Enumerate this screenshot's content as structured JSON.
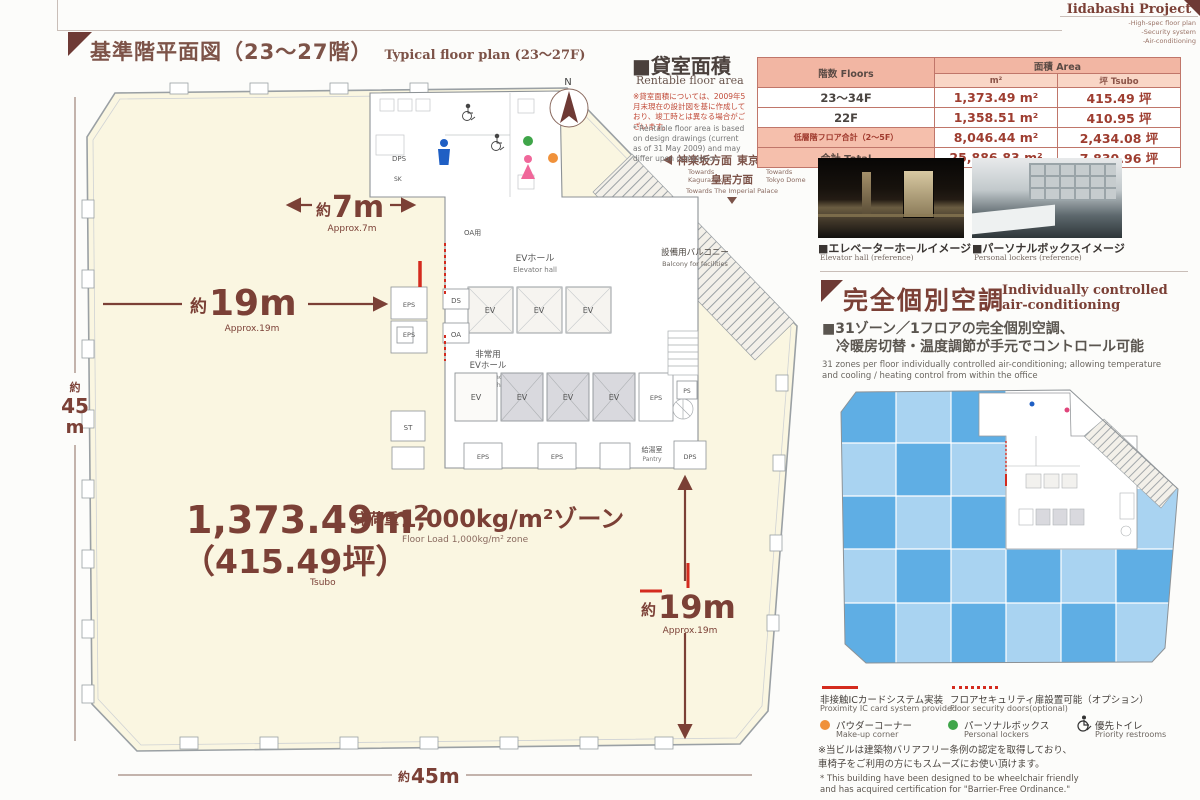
{
  "header": {
    "brand": "Iidabashi Project",
    "sub": [
      "-High-spec floor plan",
      "-Security system",
      "-Air-conditioning"
    ]
  },
  "title": {
    "jp": "基準階平面図（23〜27階）",
    "en": "Typical floor plan (23〜27F)"
  },
  "rentable": {
    "heading_jp": "■貸室面積",
    "heading_en": "Rentable floor area",
    "note_jp": "※貸室面積については、2009年5月末現在の設計図を基に作成しており、竣工時とは異なる場合がございます。",
    "note_en": "* Rentable floor area is based on design drawings (current as of 31 May 2009) and may differ upon completion.",
    "table": {
      "col_floors": "階数 Floors",
      "col_area": "面積 Area",
      "col_m2": "m²",
      "col_tsubo": "坪 Tsubo",
      "rows": [
        {
          "floor": "23〜34F",
          "m2": "1,373.49 m²",
          "tsubo": "415.49 坪"
        },
        {
          "floor": "22F",
          "m2": "1,358.51 m²",
          "tsubo": "410.95 坪"
        },
        {
          "floor": "低層階フロア合計（2〜5F）",
          "m2": "8,046.44 m²",
          "tsubo": "2,434.08 坪"
        },
        {
          "floor": "合計 Total",
          "m2": "25,886.83 m²",
          "tsubo": "7,830.96 坪"
        }
      ]
    }
  },
  "photos": {
    "elevator_jp": "■エレベーターホールイメージ",
    "elevator_en": "Elevator hall (reference)",
    "lockers_jp": "■パーソナルボックスイメージ",
    "lockers_en": "Personal lockers (reference)"
  },
  "aircon": {
    "title_jp": "完全個別空調",
    "title_en1": "Individually controlled",
    "title_en2": "air-conditioning",
    "sub_jp1": "■31ゾーン／1フロアの完全個別空調、",
    "sub_jp2": "冷暖房切替・温度調節が手元でコントロール可能",
    "body_en1": "31 zones per floor individually controlled air-conditioning; allowing temperature",
    "body_en2": "and cooling / heating control from within the office"
  },
  "legend": {
    "ic_jp": "非接触ICカードシステム実装",
    "ic_en": "Proximity IC card system provided",
    "door_jp": "フロアセキュリティ扉設置可能（オプション）",
    "door_en": "Floor security doors(optional)",
    "makeup_jp": "パウダーコーナー",
    "makeup_en": "Make-up corner",
    "locker_jp": "パーソナルボックス",
    "locker_en": "Personal lockers",
    "priority_jp": "優先トイレ",
    "priority_en": "Priority restrooms",
    "note_jp1": "※当ビルは建築物バリアフリー条例の認定を取得しており、",
    "note_jp2": "車椅子をご利用の方にもスムーズにお使い頂けます。",
    "note_en1": "* This building have been designed to be wheelchair friendly",
    "note_en2": "and has acquired certification for \"Barrier-Free Ordinance.\""
  },
  "plan": {
    "compass_n": "N",
    "dim7": {
      "prefix": "約",
      "value": "7m",
      "en": "Approx.7m"
    },
    "dim19": {
      "prefix": "約",
      "value": "19m",
      "en": "Approx.19m"
    },
    "dim45v": {
      "prefix": "約",
      "num": "45",
      "unit": "m"
    },
    "dim45b": {
      "prefix": "約",
      "value": "45m"
    },
    "area": {
      "m2": "1,373.49m²",
      "tsubo": "（415.49坪）",
      "tsubo_en": "Tsubo"
    },
    "load": {
      "jp_prefix": "床荷重",
      "jp_value": "1,000kg/m²ゾーン",
      "en": "Floor Load 1,000kg/m² zone"
    },
    "directions": {
      "kagurazaka_jp": "神楽坂方面",
      "kagurazaka_en1": "Towards",
      "kagurazaka_en2": "Kagurazaka",
      "dome_jp": "東京ドーム方面",
      "dome_en1": "Towards",
      "dome_en2": "Tokyo Dome",
      "palace_jp": "皇居方面",
      "palace_en": "Towards The Imperial Palace"
    },
    "balcony_jp": "設備用バルコニー",
    "balcony_en": "Balcony for facilities",
    "labels": {
      "ev_hall_jp": "EVホール",
      "ev_hall_en": "Elevator hall",
      "emg1": "非常用",
      "emg2": "EVホール",
      "emg_en1": "Emergency",
      "emg_en2": "Elevator hall",
      "pantry_jp": "給湯室",
      "pantry_en": "Pantry",
      "ev": "EV",
      "eps": "EPS",
      "ps": "PS",
      "ds": "DS",
      "oa": "OA",
      "oa_room": "OA用",
      "st": "ST",
      "dps": "DPS",
      "sk": "SK"
    }
  },
  "colors": {
    "accent_maroon": "#6E3A35",
    "dim_red": "#7B4036",
    "security_red": "#D42B1E",
    "table_header_bg": "#F2B6A3",
    "table_value_text": "#9E3D30",
    "office_cream": "#FAF6E1",
    "zone_blue_light": "#A9D3F1",
    "zone_blue_mid": "#5FAEE4",
    "makeup_orange": "#F0913A",
    "locker_green": "#3FA549"
  }
}
